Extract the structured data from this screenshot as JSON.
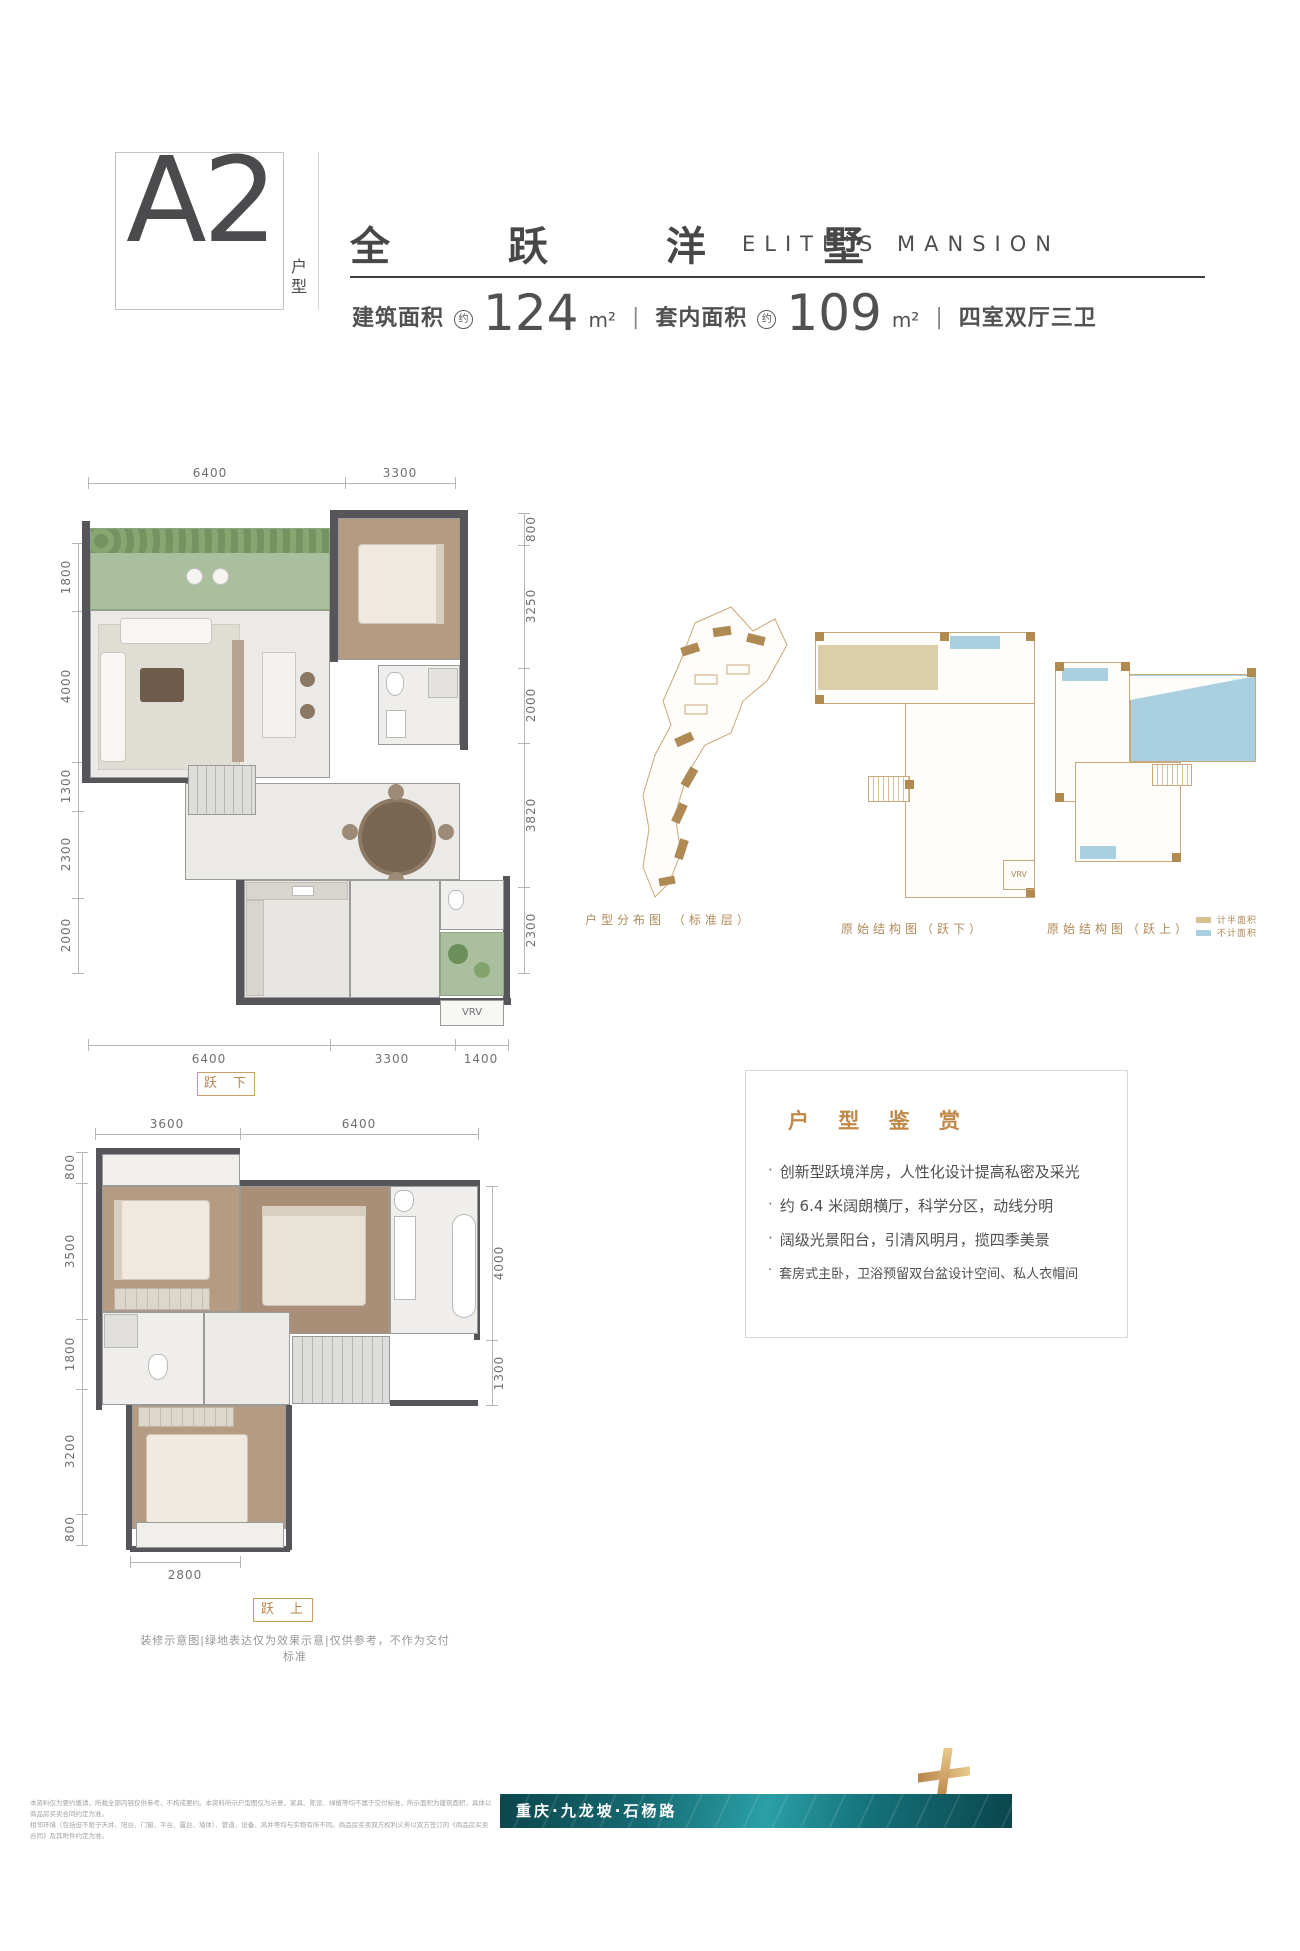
{
  "header": {
    "unit_code": "A2",
    "unit_type_label": "户型",
    "title_cn": "全 跃 洋 墅",
    "title_en": "ELITE'S MANSION",
    "built_area_label": "建筑面积",
    "approx": "约",
    "built_area_value": "124",
    "area_unit": "m²",
    "inner_area_label": "套内面积",
    "inner_area_value": "109",
    "rooms_text": "四室双厅三卫",
    "divider": "|"
  },
  "plan_lower": {
    "tag": "跃 下",
    "vrv_label": "VRV",
    "dims_top": [
      "6400",
      "3300"
    ],
    "dims_bottom": [
      "6400",
      "3300",
      "1400"
    ],
    "dims_left": [
      "1800",
      "4000",
      "1300",
      "2300",
      "2000"
    ],
    "dims_right": [
      "800",
      "3250",
      "2000",
      "3820",
      "2300"
    ]
  },
  "plan_upper": {
    "tag": "跃 上",
    "dims_top": [
      "3600",
      "6400"
    ],
    "dims_bottom": [
      "2800"
    ],
    "dims_left": [
      "800",
      "3500",
      "1800",
      "3200",
      "800"
    ],
    "dims_right": [
      "4000",
      "1300"
    ],
    "note": "装修示意图|绿地表达仅为效果示意|仅供参考，不作为交付标准"
  },
  "diagrams": {
    "distribution_label": "户型分布图 （标准层）",
    "structure_lower_label": "原始结构图（跃下）",
    "structure_upper_label": "原始结构图（跃上）",
    "vrv_label": "VRV",
    "legend": [
      {
        "label": "计半面积",
        "color": "#d8c092"
      },
      {
        "label": "不计面积",
        "color": "#a9cfe0"
      }
    ]
  },
  "appreciation": {
    "title": "户 型 鉴 赏",
    "marker": "·",
    "bullets": [
      "创新型跃境洋房，人性化设计提高私密及采光",
      "约 6.4 米阔朗横厅，科学分区，动线分明",
      "阔级光景阳台，引清风明月，揽四季美景",
      "套房式主卧，卫浴预留双台盆设计空间、私人衣帽间"
    ]
  },
  "footer": {
    "disclaimer_line1": "本资料仅为要约邀请，所载全部内容仅供参考，不构成要约。本资料所示户型图仅为示意，家具、陈设、绿植等均不属于交付标准，所示面积为建筑面积，具体以商品房买卖合同约定为准。",
    "disclaimer_line2": "相邻环境（包括但不限于天井、阳台、门窗、平台、露台、墙体）、管道、设备、风井等均与实物有所不同。商品房买卖双方权利义务以双方签订的《商品房买卖合同》及其附件约定为准。",
    "location": "重庆·九龙坡·石杨路",
    "banner_color": "#156a72",
    "accent_gold": "#c9a05e"
  }
}
